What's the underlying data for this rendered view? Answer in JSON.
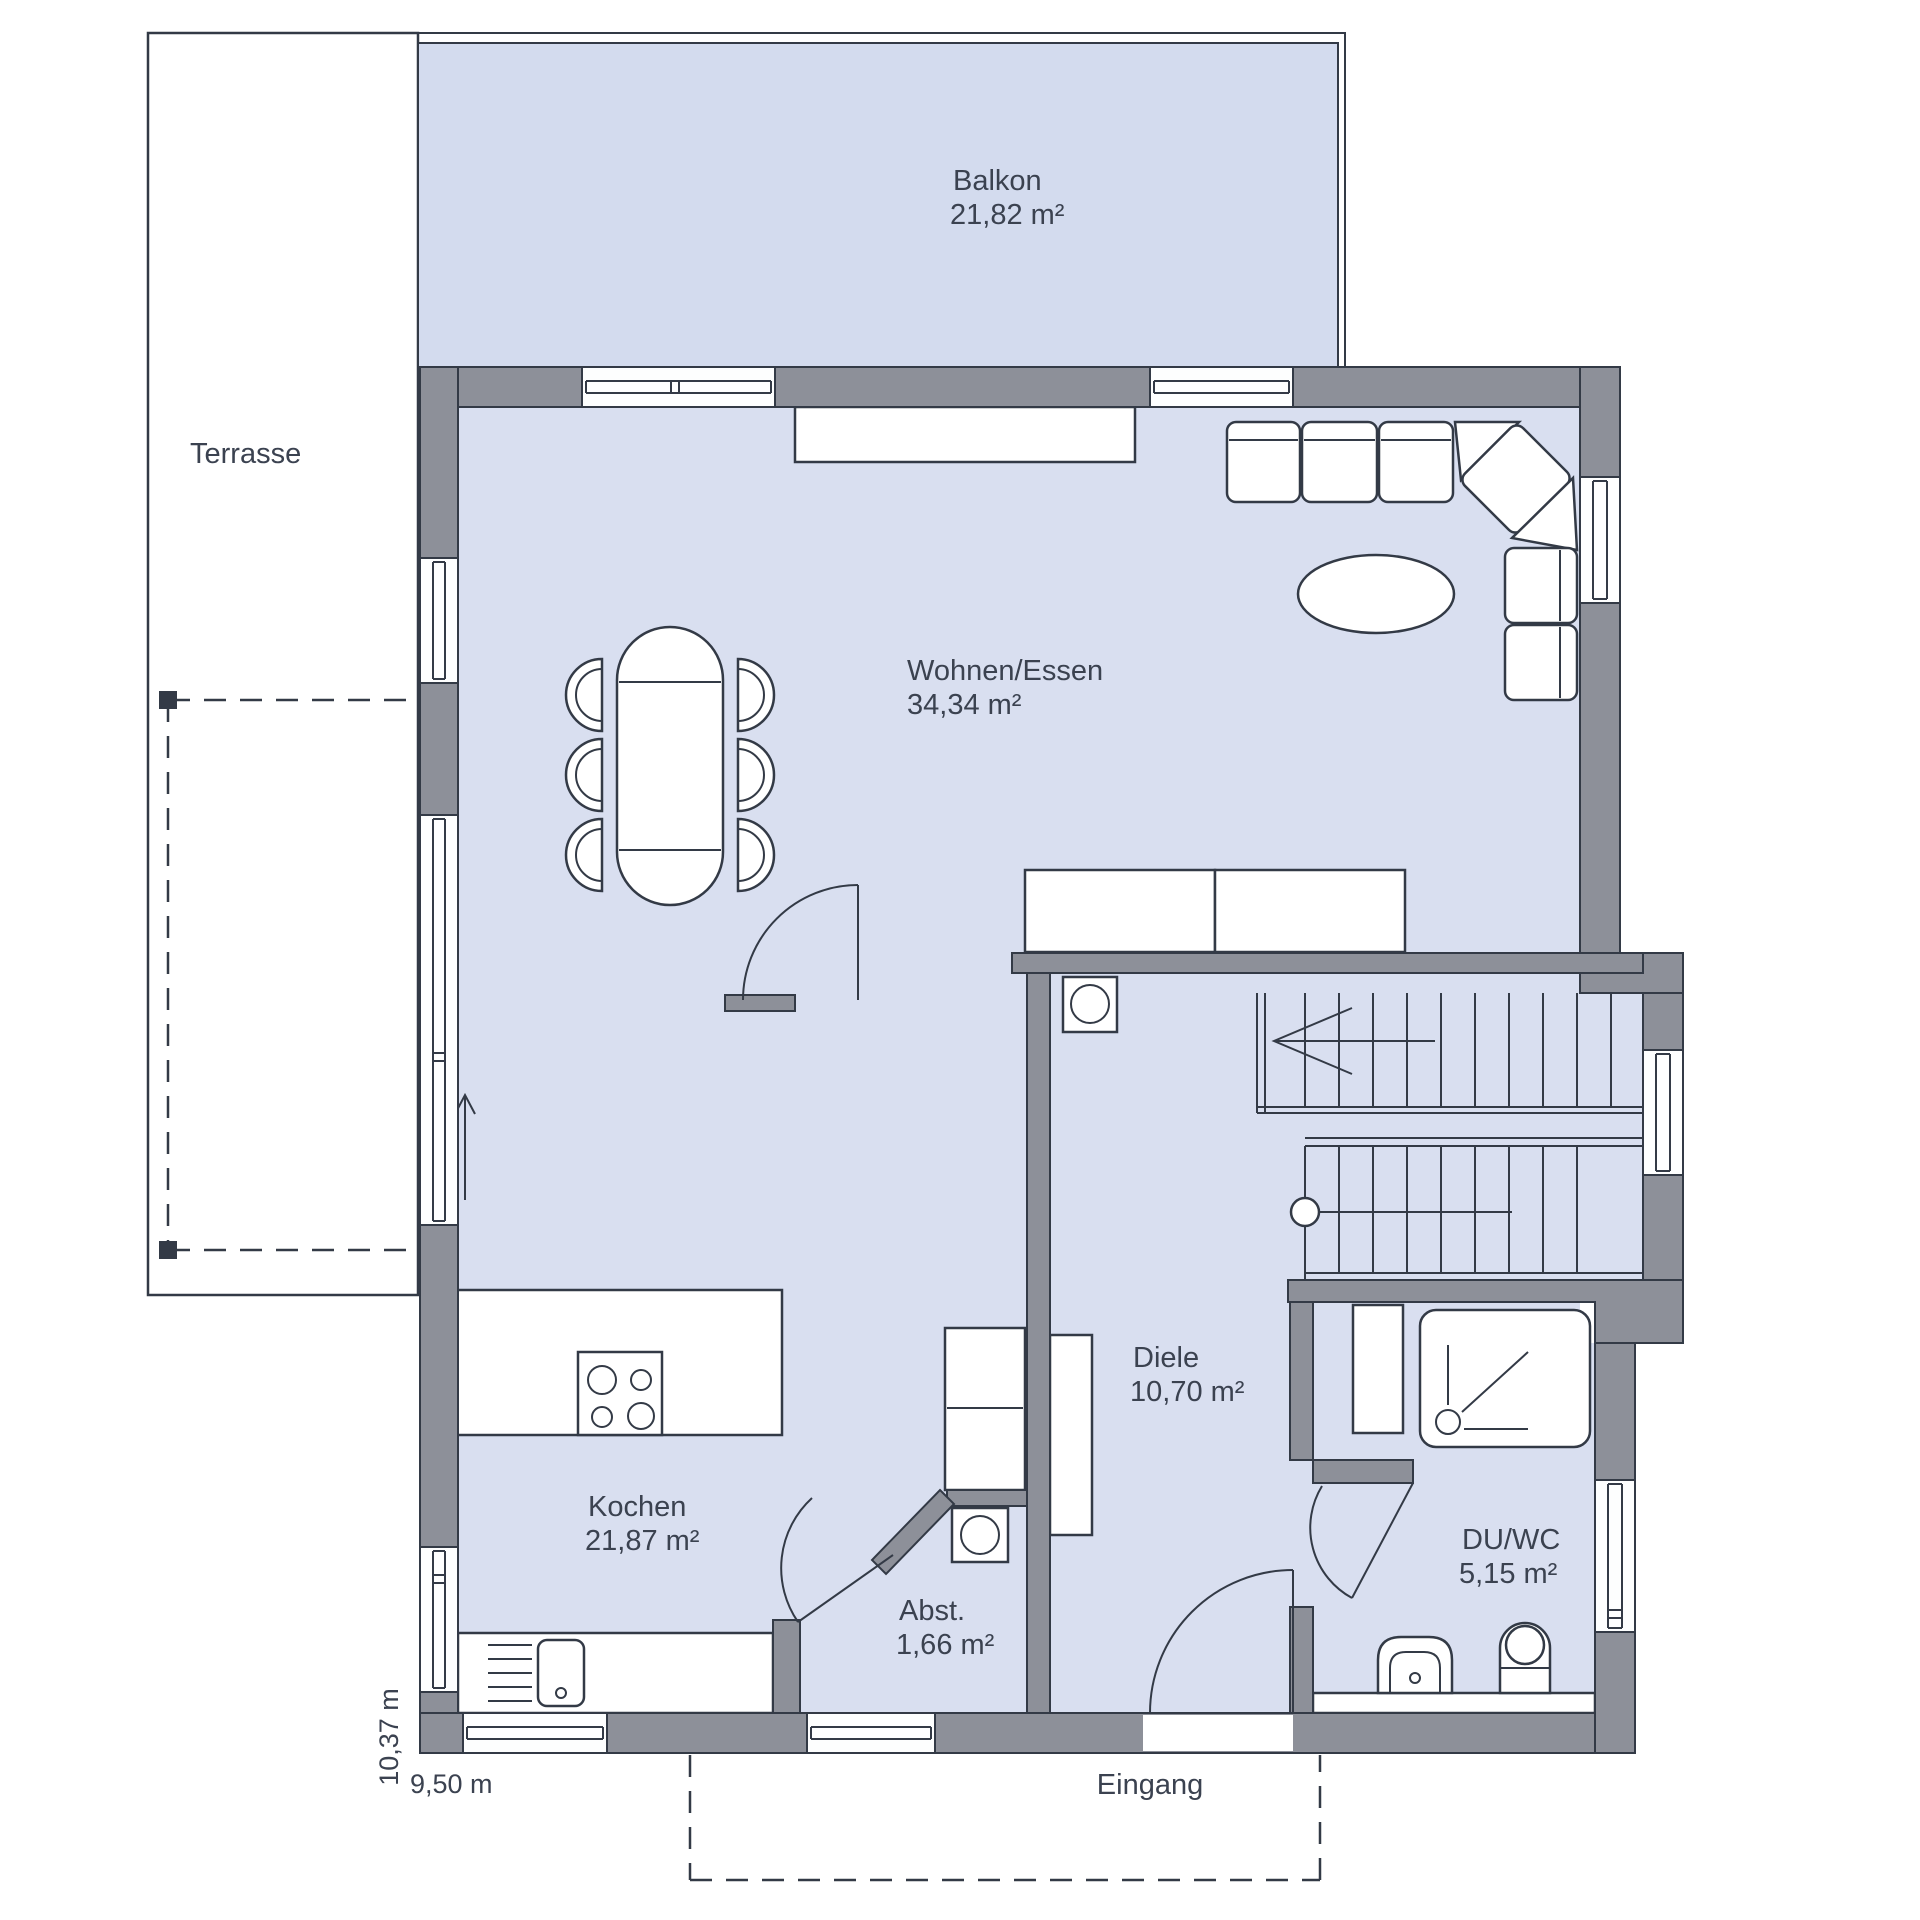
{
  "plan": {
    "type": "floor-plan",
    "outdoor": {
      "terrace": {
        "label": "Terrasse"
      },
      "balcony": {
        "label": "Balkon",
        "area": "21,82 m²"
      },
      "entrance": {
        "label": "Eingang"
      }
    },
    "rooms": [
      {
        "name": "Wohnen/Essen",
        "area": "34,34 m²"
      },
      {
        "name": "Kochen",
        "area": "21,87 m²"
      },
      {
        "name": "Diele",
        "area": "10,70 m²"
      },
      {
        "name": "Abst.",
        "area": "1,66 m²"
      },
      {
        "name": "DU/WC",
        "area": "5,15 m²"
      }
    ],
    "dimensions": {
      "width": "9,50 m",
      "height": "10,37 m"
    },
    "colors": {
      "wall": "#8d9099",
      "room_fill": "#d9dff0",
      "balcony_fill": "#d3dbee",
      "outline": "#333a46",
      "text": "#3b4250",
      "background": "#ffffff"
    }
  }
}
